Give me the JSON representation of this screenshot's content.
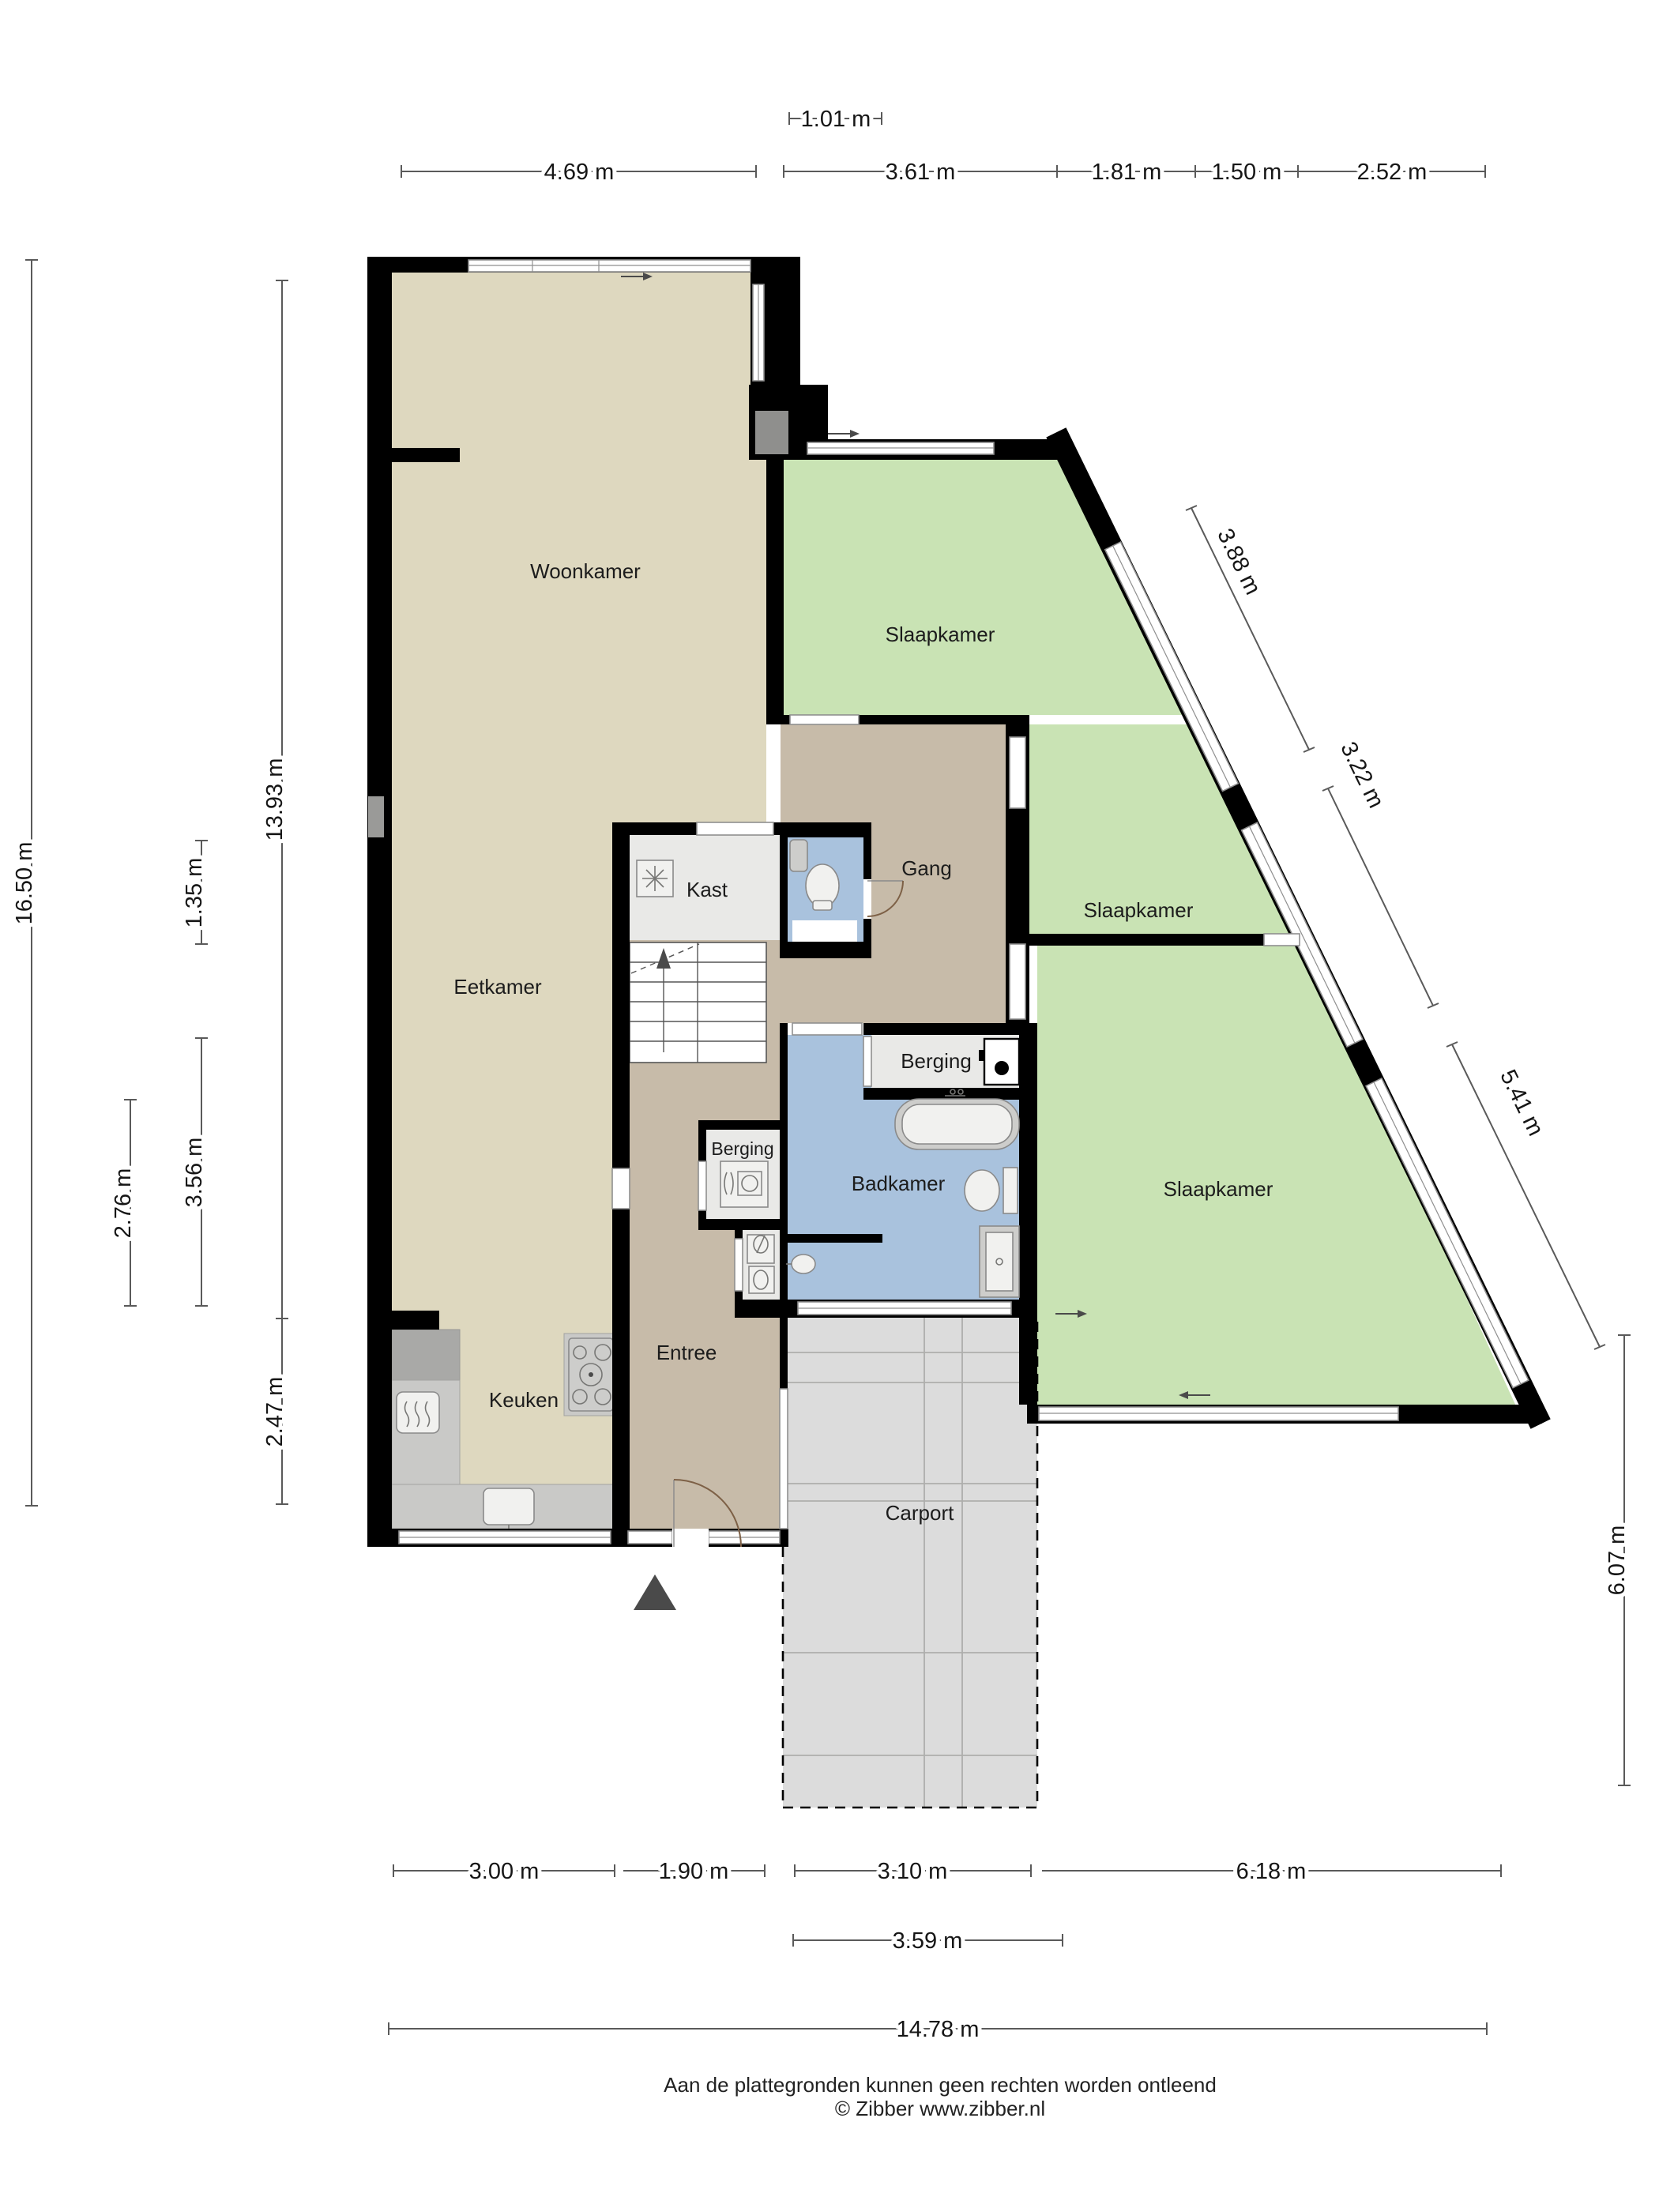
{
  "rooms": {
    "woonkamer": "Woonkamer",
    "eetkamer": "Eetkamer",
    "keuken": "Keuken",
    "entree": "Entree",
    "kast": "Kast",
    "gang": "Gang",
    "berging_gang": "Berging",
    "berging_entree": "Berging",
    "badkamer": "Badkamer",
    "slaapkamer_boven": "Slaapkamer",
    "slaapkamer_midden": "Slaapkamer",
    "slaapkamer_onder": "Slaapkamer",
    "carport": "Carport"
  },
  "dims": {
    "top_offset": "1.01 m",
    "top": [
      "4.69 m",
      "3.61 m",
      "1.81 m",
      "1.50 m",
      "2.52 m"
    ],
    "left": [
      "16.50 m",
      "13.93 m",
      "1.35 m",
      "3.56 m",
      "2.76 m",
      "2.47 m"
    ],
    "diagonal": [
      "3.88 m",
      "3.22 m",
      "5.41 m"
    ],
    "right": "6.07 m",
    "bottom": [
      "3.00 m",
      "1.90 m",
      "3.10 m",
      "6.18 m"
    ],
    "bottom_carport": "3.59 m",
    "bottom_total": "14.78 m"
  },
  "footer": {
    "disclaimer": "Aan de plattegronden kunnen geen rechten worden ontleend",
    "copyright": "© Zibber www.zibber.nl"
  },
  "colors": {
    "wall": "#000000",
    "floor_living": "#ded8bf",
    "floor_hall": "#c7bba9",
    "floor_bedroom": "#c9e3b4",
    "floor_bathroom": "#a9c2dd",
    "floor_storage": "#e9e9e7",
    "floor_carport": "#dcdcdc",
    "counter": "#c9c9c7",
    "dimension_line": "#5a5a5a"
  }
}
